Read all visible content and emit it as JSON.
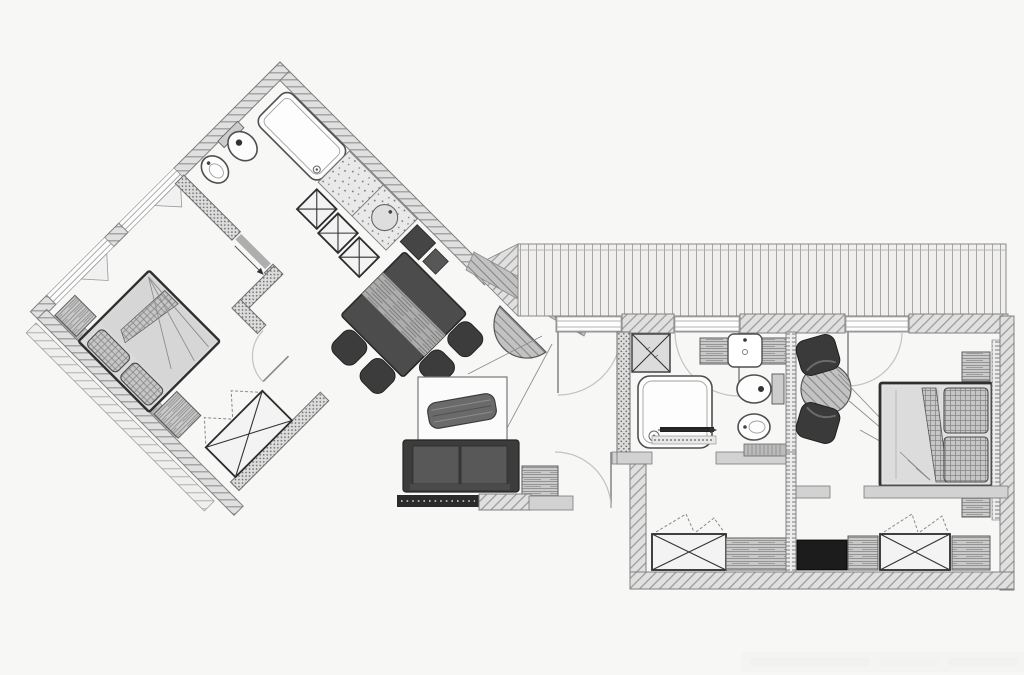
{
  "document": {
    "type": "architectural-floor-plan",
    "description": "Black and white apartment floor plan: a 45-degree rotated left wing (bathroom, kitchen-dining area, bedroom, hallway with wardrobe) joined to a horizontal right wing (living room, second bathroom, sitting corner, second bedroom, closet hallway) with a long slatted balcony running across the top right",
    "visible_text": "none",
    "watermark_present": true,
    "watermark_legible": false
  },
  "colors": {
    "bg": "#f7f7f6",
    "wall_plain": "#d2d2d2",
    "wall_stroke": "#6f6f6f",
    "fixture_stroke": "#4f4f4f",
    "dark_furniture": "#3c3c3c",
    "mid_furniture": "#585858",
    "black_cabinet": "#1c1c1c",
    "arc_color": "#c2c2c2",
    "leader_color": "#8a8a8a",
    "paper": "#fbfbfb"
  },
  "rooms": {
    "bathroom_left": {
      "label": "Left wing bathroom",
      "fixtures": [
        "bathtub",
        "toilet",
        "bidet",
        "sliding door"
      ]
    },
    "kitchen_dining": {
      "label": "Kitchen and dining area",
      "fixtures": [
        "worktop with round sink",
        "cooktop",
        "3 cabinets marked with X",
        "dark dining table with wood runner",
        "4 chairs"
      ]
    },
    "bedroom_left": {
      "label": "Left wing bedroom",
      "fixtures": [
        "double bed rotated 45 degrees",
        "2 hatched pillows",
        "2 nightstands",
        "wardrobe with X and dashed open doors",
        "casement windows"
      ]
    },
    "balcony": {
      "label": "Balcony with plank decking",
      "fixtures": [
        "vertical plank decking",
        "angled end deck",
        "3 french windows with swing arcs"
      ]
    },
    "living_room": {
      "label": "Living room",
      "fixtures": [
        "half-round wall table",
        "area rug",
        "log bench on rug",
        "two-seat sofa",
        "wood side table",
        "radiator strip"
      ]
    },
    "bathroom_right": {
      "label": "Right wing bathroom",
      "fixtures": [
        "shower stall marked with X",
        "square bathtub with drain",
        "vanity with washbasin",
        "toilet",
        "bidet",
        "sliding door with arrow",
        "radiator"
      ]
    },
    "sitting_corner": {
      "label": "Sitting corner",
      "fixtures": [
        "round wood table",
        "2 dark armchairs"
      ]
    },
    "bedroom_right": {
      "label": "Right wing bedroom",
      "fixtures": [
        "double bed",
        "2 hatched pillows",
        "dark fold wedge",
        "2 nightstands",
        "french window"
      ]
    },
    "closet_hall": {
      "label": "Closet hallway",
      "fixtures": [
        "2 wardrobes with X and dashed open doors",
        "3 wood dressers",
        "dark cabinet",
        "partition wall"
      ]
    }
  }
}
